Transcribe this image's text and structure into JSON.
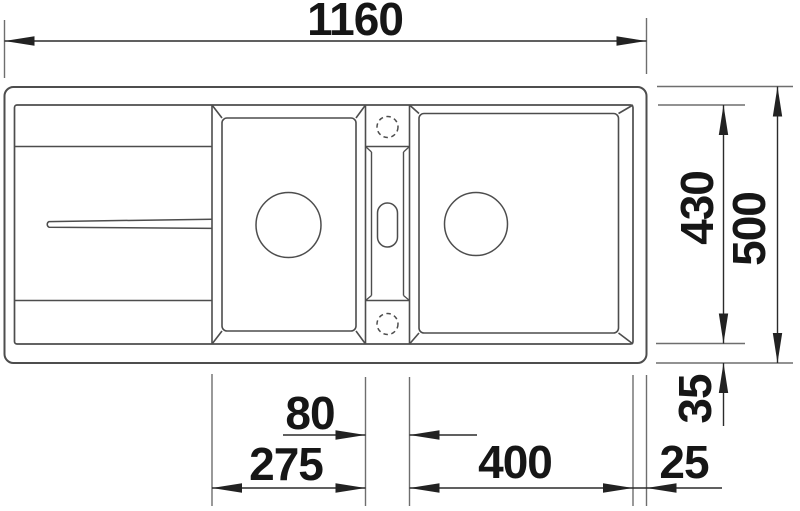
{
  "drawing": {
    "type": "sink-installation-technical-drawing",
    "dimensions": {
      "overall_width": "1160",
      "overall_depth": "500",
      "inner_depth": "430",
      "bottom_rim_offset": "35",
      "right_edge_offset": "25",
      "right_bowl_width": "400",
      "divider_width": "80",
      "left_bowl_width": "275"
    },
    "colors": {
      "background": "#ffffff",
      "outline": "#4d4d4d",
      "extension_line": "#6e6e6e",
      "dimension_line": "#2b2b2b",
      "text": "#161616"
    }
  }
}
